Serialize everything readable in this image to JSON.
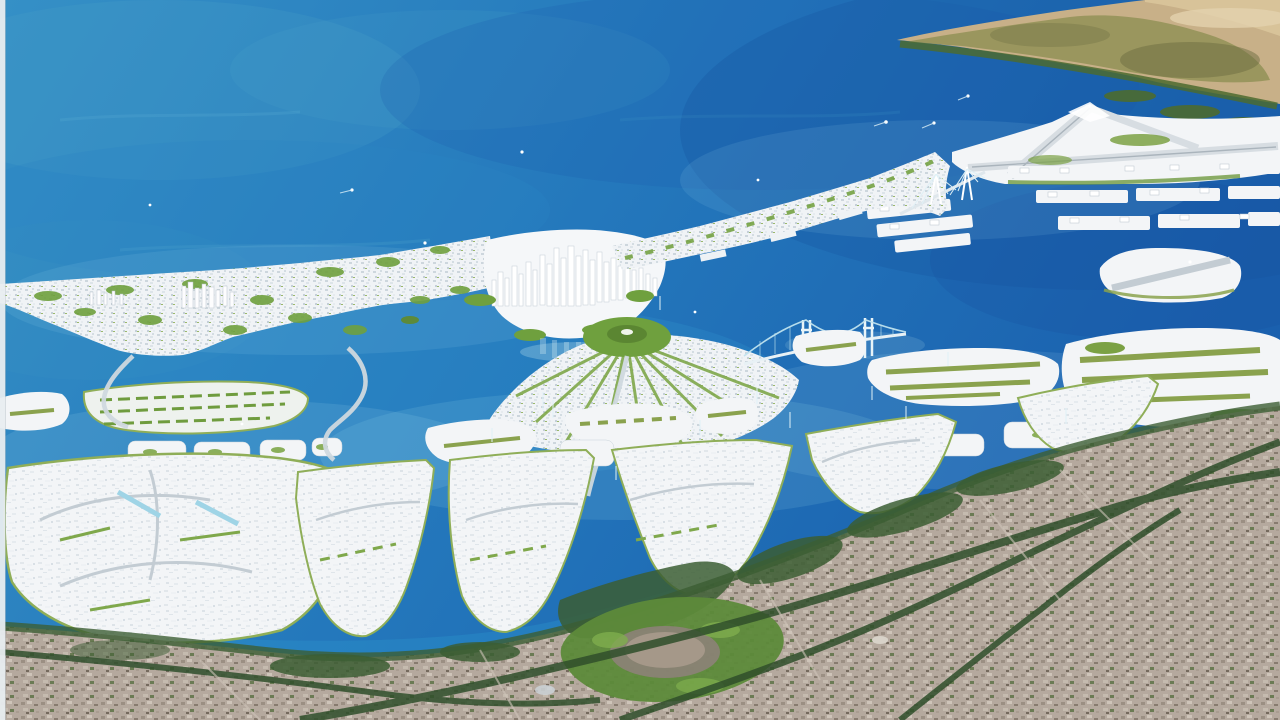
{
  "meta": {
    "description": "Aerial artist's rendering of a coastal land-reclamation master plan: a curved arc of white artificial islands with a high-rise CBD in a blue bay, a fan-shaped radial island, suspension and cable-stayed bridges, an airport island and seaport piers, a hilly headland on the horizon, and the existing shoreline city in the foreground.",
    "visible_text": []
  },
  "palette": {
    "ocean_top": "#3590c6",
    "ocean_mid": "#2478bc",
    "ocean_deep": "#1a60ae",
    "ocean_teal": "#4fa6c8",
    "lagoon": "#2f8cc9",
    "shallow": "#9fd9ec",
    "channel_bright": "#2f9bd0",
    "island_white": "#f3f5f7",
    "island_shade": "#c9d3da",
    "park_green": "#6fa03e",
    "hedge_green": "#7fa84b",
    "rim_green": "#8fae58",
    "dark_green": "#3c5e33",
    "forest_green": "#2f4f2b",
    "golf_green": "#5d8a3a",
    "headland_tan": "#c8b088",
    "headland_olive": "#8f9054",
    "sand_ridge": "#d9c49a",
    "mainland_base": "#b5a99e",
    "road_gray": "#cfd8de",
    "runway_gray": "#d7dde2",
    "bridge_cyan": "#bfe3ee",
    "bridge_deck": "#e8f1f5",
    "border_edge": "#e8edf0",
    "boat_white": "#ffffff"
  },
  "regions": [
    {
      "name": "ocean",
      "desc": "open bay water, lighter teal upper-left, deeper blue right"
    },
    {
      "name": "headland-peninsula",
      "desc": "brown-olive hilly cape with sandy ridge, top right horizon"
    },
    {
      "name": "airport-island",
      "desc": "white reclaimed island with crossing runways"
    },
    {
      "name": "seaport-piers",
      "desc": "rows of white container wharves"
    },
    {
      "name": "barrier-city-west",
      "desc": "dense low-rise white city on curved barrier island, left"
    },
    {
      "name": "cbd-skyline",
      "desc": "cluster of white skyscrapers at center of the arc"
    },
    {
      "name": "barrier-city-east",
      "desc": "white urban strip rising toward the airport"
    },
    {
      "name": "fan-island",
      "desc": "radial island with green semicircular park at its apex"
    },
    {
      "name": "suspension-bridge",
      "desc": "two-tower bridge linking fan island to eastern islands"
    },
    {
      "name": "cable-stay-towers",
      "desc": "small bridge towers by the airport approach"
    },
    {
      "name": "islet-chain",
      "desc": "string of small white marina islets across the lagoon"
    },
    {
      "name": "mid-islands",
      "desc": "mid-size white islands with olive planting strips"
    },
    {
      "name": "south-islands",
      "desc": "large white reclamation islands in the foreground"
    },
    {
      "name": "garden-island",
      "desc": "landscaped island with rows of green planting, left"
    },
    {
      "name": "causeway-roads",
      "desc": "S-curved causeways descending from the barrier city"
    },
    {
      "name": "mainland-city",
      "desc": "existing gray-tan urban fabric along the shore"
    },
    {
      "name": "golf-course",
      "desc": "looping green course in the foreground city"
    },
    {
      "name": "highway-corridors",
      "desc": "dark tree-lined expressways crossing the mainland"
    },
    {
      "name": "boats",
      "desc": "tiny white vessels with wakes on the bay"
    }
  ]
}
